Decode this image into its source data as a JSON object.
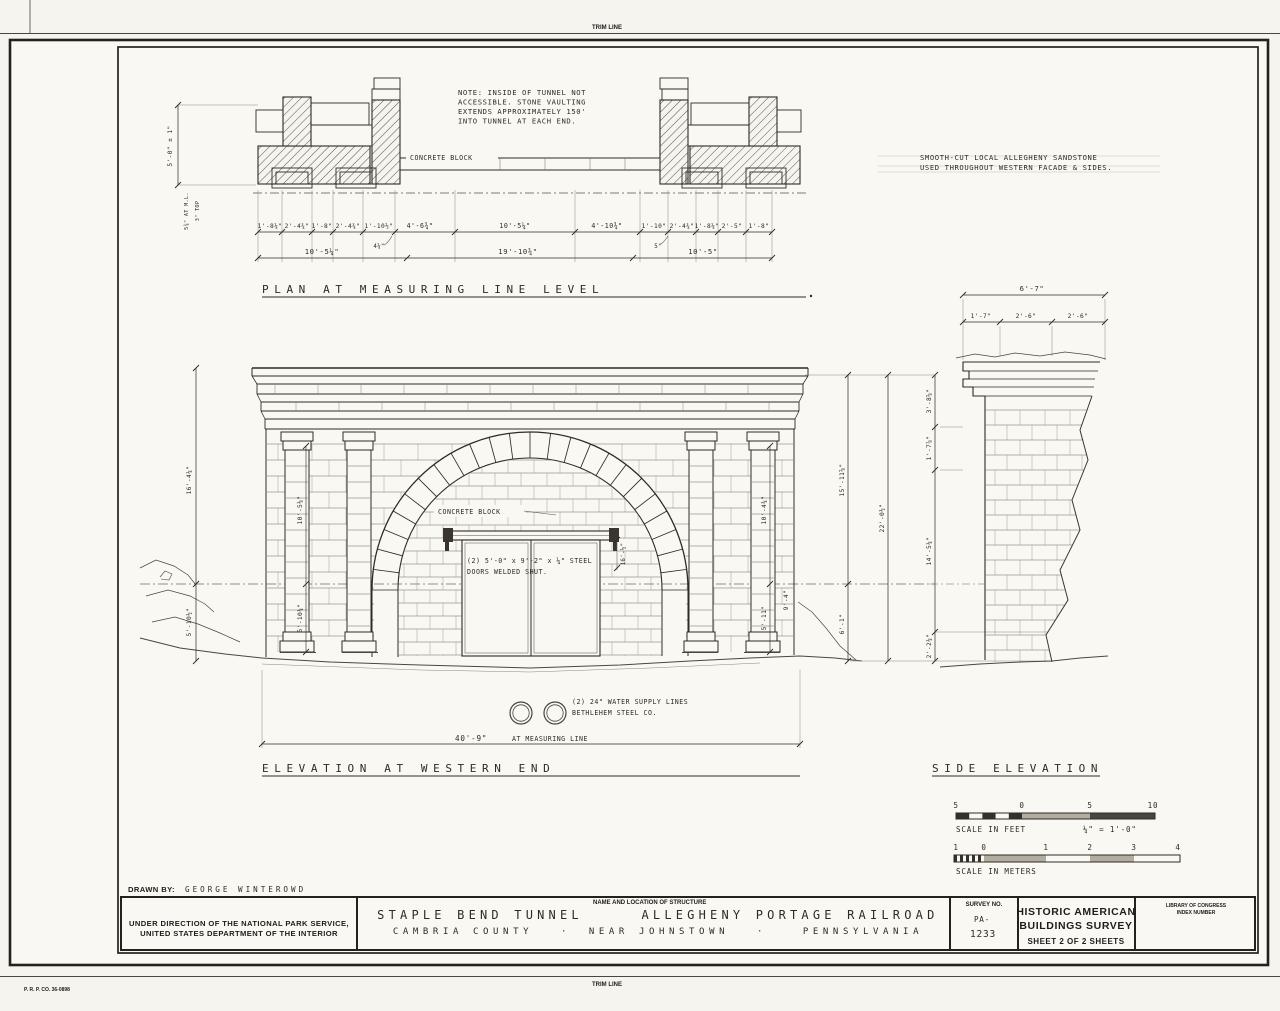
{
  "sheet": {
    "trim_line_top": "TRIM LINE",
    "trim_line_bottom": "TRIM LINE",
    "printer_code": "P. R. P. CO.  36-0898",
    "stamp_line1": "DUE TO INSUFFICIENT INFORMATION AT THE",
    "stamp_line2": "TIME OF EDITING, THIS MATERIAL MAY NOT",
    "stamp_line3": "CONFORM TO HABS OR HAER STANDARDS."
  },
  "plan": {
    "title": "PLAN AT MEASURING LINE LEVEL",
    "note_line1": "NOTE: INSIDE OF TUNNEL NOT",
    "note_line2": "ACCESSIBLE. STONE VAULTING",
    "note_line3": "EXTENDS APPROXIMATELY 150'",
    "note_line4": "INTO TUNNEL AT EACH END.",
    "concrete_block_label": "CONCRETE BLOCK",
    "sandstone_line1": "SMOOTH-CUT LOCAL ALLEGHENY SANDSTONE",
    "sandstone_line2": "USED THROUGHOUT WESTERN FACADE & SIDES.",
    "dim_height": "5'-0\" ± 1\"",
    "dim_ml": "5¾\" AT M.L.",
    "dim_top_offset": "3\" TOP",
    "dims_top": [
      "1'-8¼\"",
      "2'-4¾\"",
      "1'-8\"",
      "2'-4¾\"",
      "1'-10½\"",
      "4'-6¾\"",
      "10'-5¼\"",
      "4'-10¾\"",
      "1'-10\"",
      "2'-4¾\"",
      "1'-8¼\"",
      "2'-5\"",
      "1'-8\""
    ],
    "dim_sub_left": "4¼\"",
    "dim_sub_right": "5\"",
    "dims_bottom": [
      "10'-5¼\"",
      "19'-10¾\"",
      "10'-5\""
    ]
  },
  "elevation": {
    "title": "ELEVATION AT WESTERN END",
    "concrete_block_label": "CONCRETE BLOCK",
    "door_note_line1": "(2) 5'-0\" x 9'-2\" x ¼\" STEEL",
    "door_note_line2": "DOORS WELDED SHUT.",
    "door_dim": "16'-½\"",
    "water_note_line1": "(2) 24\" WATER SUPPLY LINES",
    "water_note_line2": "BETHLEHEM STEEL CO.",
    "width_dim": "40'-9\"",
    "width_dim_suffix": "AT MEASURING LINE",
    "dim_left_upper": "16'-4¼\"",
    "dim_left_lower": "5'-10½\"",
    "dim_col_left_upper": "10'-5⅛\"",
    "dim_col_left_lower": "5'-10¼\"",
    "dim_col_right_upper": "10'-4¾\"",
    "dim_col_right_lower": "5'-11\"",
    "dim_right_small": "9'-4\"",
    "dim_mid_upper": "15'-11⅝\"",
    "dim_mid_lower": "6'-1\"",
    "dim_total": "22'-0½\"",
    "dim_r1": "3'-8⅝\"",
    "dim_r2": "1'-7⅞\"",
    "dim_r3": "14'-5¼\"",
    "dim_r4": "2'-2¼\""
  },
  "side": {
    "title": "SIDE ELEVATION",
    "dim_total": "6'-7\"",
    "dim_seg1": "1'-7\"",
    "dim_seg2": "2'-6\"",
    "dim_seg3": "2'-6\""
  },
  "scales": {
    "feet_l1": "5",
    "feet_l2": "0",
    "feet_l3": "5",
    "feet_l4": "10",
    "feet_caption": "SCALE IN FEET",
    "feet_ratio": "¼\" = 1'-0\"",
    "m_l1": "1",
    "m_l2": "0",
    "m_l3": "1",
    "m_l4": "2",
    "m_l5": "3",
    "m_l6": "4",
    "meters_caption": "SCALE IN METERS"
  },
  "title_block": {
    "drawn_by_label": "DRAWN BY:",
    "drawn_by_name": "GEORGE WINTEROWD",
    "agency_line1": "UNDER DIRECTION OF THE NATIONAL PARK SERVICE,",
    "agency_line2": "UNITED STATES DEPARTMENT OF THE INTERIOR",
    "structure_header": "NAME AND LOCATION OF STRUCTURE",
    "structure_name_1": "STAPLE BEND TUNNEL",
    "structure_name_2": "ALLEGHENY PORTAGE RAILROAD",
    "location_1": "CAMBRIA COUNTY",
    "dot1": "·",
    "location_2": "NEAR JOHNSTOWN",
    "dot2": "·",
    "location_3": "PENNSYLVANIA",
    "survey_label": "SURVEY NO.",
    "survey_no_line1": "PA-",
    "survey_no_line2": "1233",
    "habs_line1": "HISTORIC AMERICAN",
    "habs_line2": "BUILDINGS SURVEY",
    "sheet_info": "SHEET 2  OF 2  SHEETS",
    "loc_line1": "LIBRARY OF CONGRESS",
    "loc_line2": "INDEX NUMBER"
  }
}
